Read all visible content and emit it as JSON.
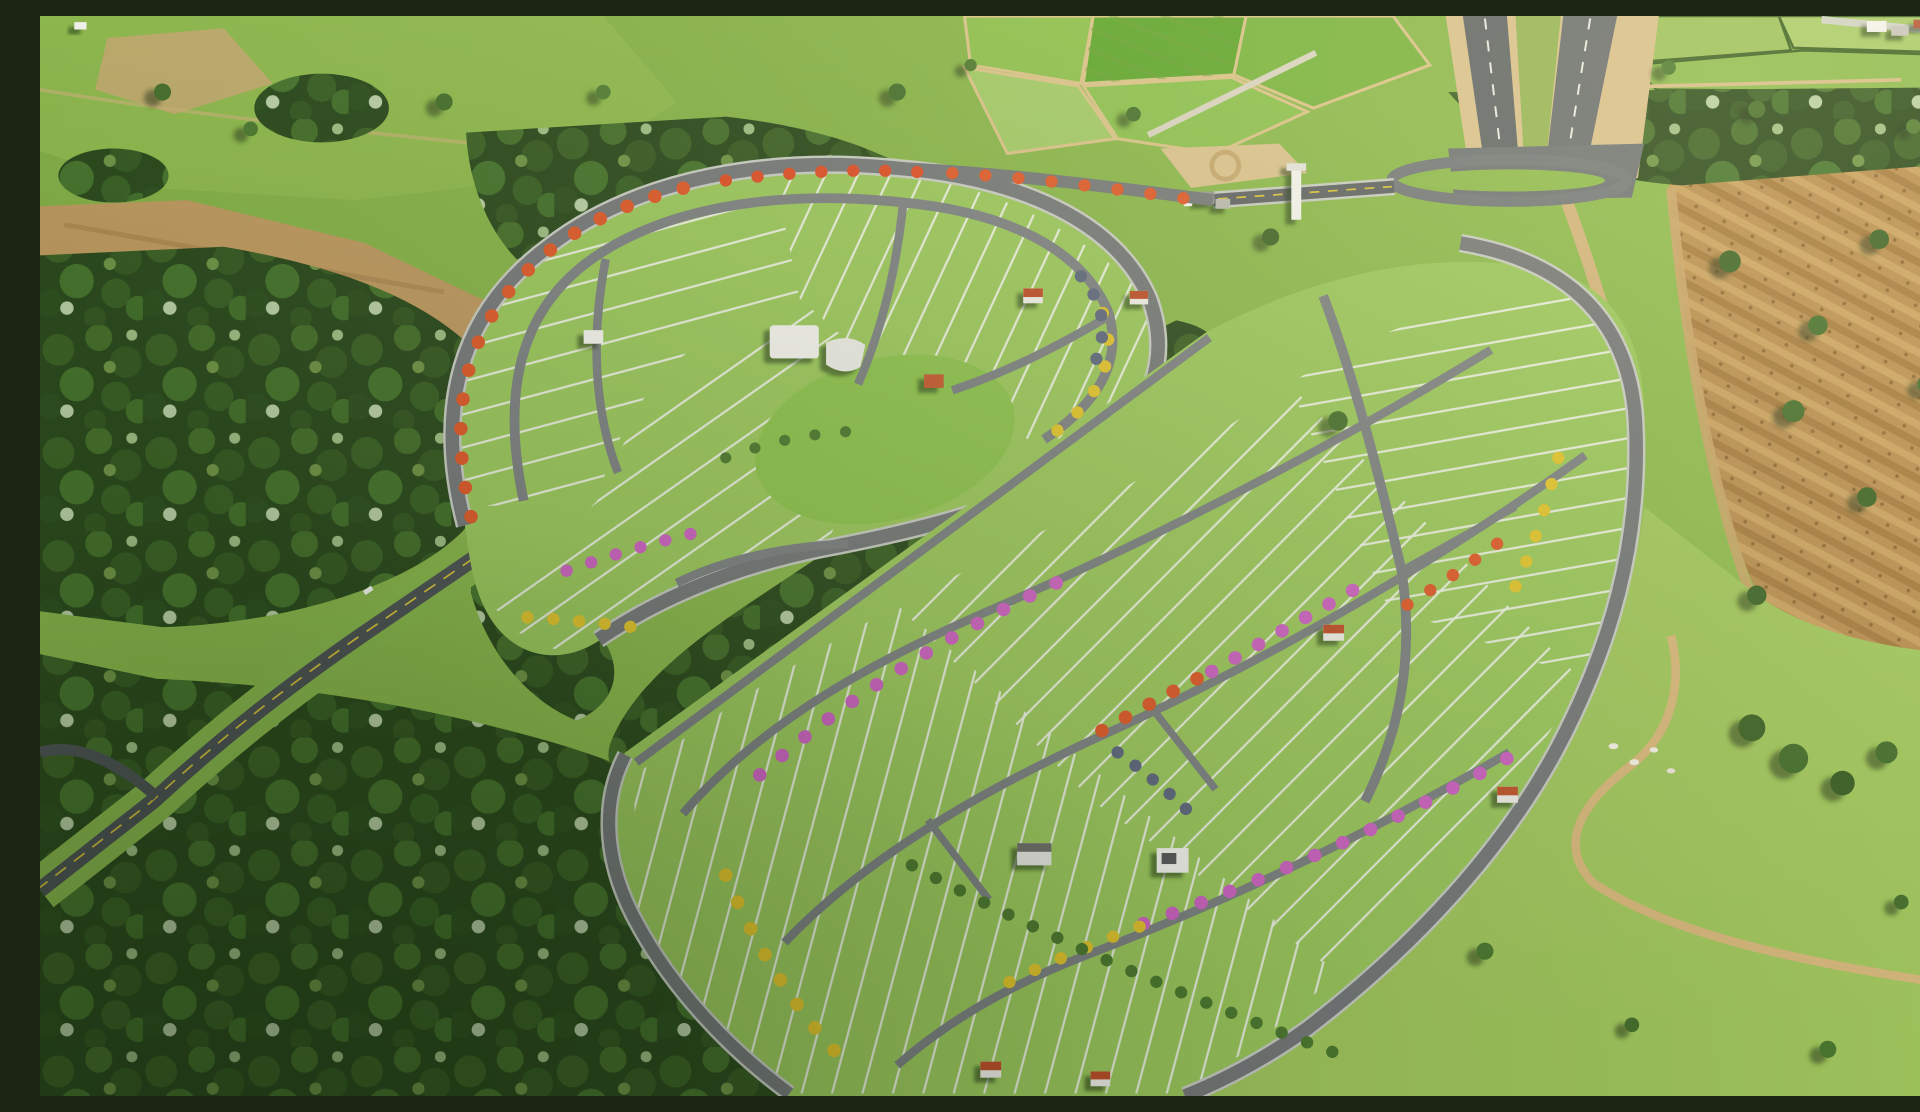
{
  "scene": {
    "title": "Aerial 3D render of a residential land-lot subdivision surrounded by forest, pasture and farm fields",
    "description": "Oblique drone-style architectural rendering. Two curved fan-shaped lot clusters with gray streets, white lot lines and rows of flowering trees (orange, pink, yellow) sit in bright green lawn. Dense dark forest bands frame the left and center. A highway at top leads to a gated entrance with a white monument pylon. Brown plowed fields and open pasture with a winding dirt track fill the right side.",
    "regions": {
      "phase1": "Oval subdivision cluster with clubhouse and central lawn",
      "phase2": "Large fan-shaped subdivision of staked lots",
      "forest": "Native forest reserve",
      "highway": "Divided access highway",
      "entrance": "Gated entrance loop with monument pylon",
      "farmland": "Patchwork of crop fields",
      "plowed": "Plowed brown field with scattered trees",
      "pasture": "Open pasture with dirt track and cattle",
      "avenue": "Access avenue through the forest",
      "pond": "Small farm pond",
      "clubhouse": "White clubhouse buildings",
      "houses": "Model houses with terracotta roofs"
    },
    "palette": {
      "grass_bright": "#9CC85E",
      "grass_base": "#85B14A",
      "pasture_light": "#A3C85F",
      "forest_dark": "#2C4A1E",
      "forest_mid": "#3F6428",
      "road_asphalt": "#6E7374",
      "avenue_asphalt": "#4E5456",
      "road_casing": "#C8CCC4",
      "lot_line": "#EFF3E6",
      "centerline_yellow": "#D8C23A",
      "soil_plow": "#B98F52",
      "dirt_sand": "#D5B97E",
      "clearing_brown": "#B08B52",
      "tree_orange": "#E05A2B",
      "tree_pink": "#CF63C4",
      "tree_yellow": "#E3C52E",
      "tree_blue_gray": "#5F6880",
      "roof_red": "#BF4F2C",
      "building_white": "#F4F4F0",
      "pond_water": "#3C4F2C",
      "cattle_white": "#F5F2E8"
    }
  }
}
